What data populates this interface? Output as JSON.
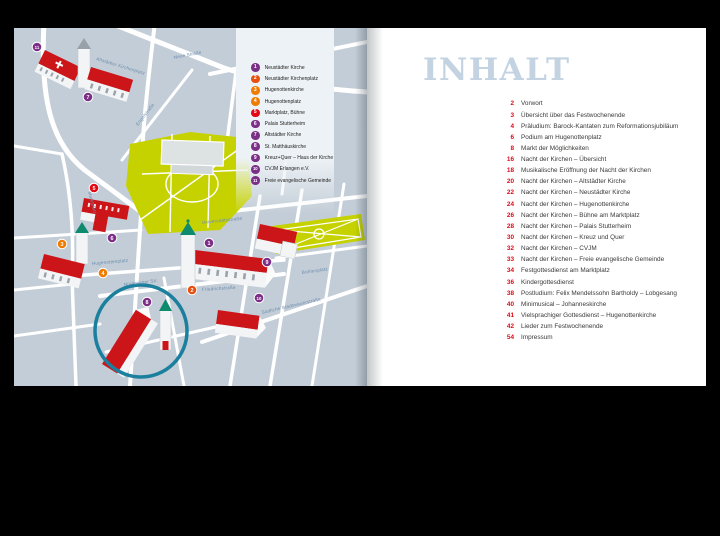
{
  "left_page": {
    "legend": {
      "items": [
        {
          "num": 1,
          "label": "Neustädter Kirche",
          "color": "#7c2f87"
        },
        {
          "num": 2,
          "label": "Neustädter Kirchenplatz",
          "color": "#e8500f"
        },
        {
          "num": 3,
          "label": "Hugenottenkirche",
          "color": "#ef7c00"
        },
        {
          "num": 4,
          "label": "Hugenottenplatz",
          "color": "#ef7c00"
        },
        {
          "num": 5,
          "label": "Marktplatz, Bühne",
          "color": "#e30613"
        },
        {
          "num": 6,
          "label": "Palais Stutterheim",
          "color": "#7c2f87"
        },
        {
          "num": 7,
          "label": "Altstädter Kirche",
          "color": "#7c2f87"
        },
        {
          "num": 8,
          "label": "St. Matthäuskirche",
          "color": "#7c2f87"
        },
        {
          "num": 9,
          "label": "Kreuz+Quer – Haus der Kirche",
          "color": "#7c2f87"
        },
        {
          "num": 10,
          "label": "CVJM Erlangen e.V.",
          "color": "#7c2f87"
        },
        {
          "num": 11,
          "label": "Freie evangelische Gemeinde",
          "color": "#7c2f87"
        }
      ]
    },
    "map": {
      "colors": {
        "background": "#c3cdd7",
        "street": "#ffffff",
        "park": "#c5d200",
        "roof": "#cc1519",
        "wall": "#f3f4f5",
        "tower_cap": "#0e8a6d",
        "highlight": "#1b7f9e",
        "label": "#6b8cad"
      },
      "street_labels": [
        {
          "text": "Altstädter Kirchenplatz",
          "x": 82,
          "y": 32,
          "rotate": 17
        },
        {
          "text": "Neue Straße",
          "x": 160,
          "y": 31,
          "rotate": -11
        },
        {
          "text": "Engelstraße",
          "x": 124,
          "y": 98,
          "rotate": -52
        },
        {
          "text": "Marktplatz",
          "x": 74,
          "y": 164,
          "rotate": 75
        },
        {
          "text": "Universitätsstraße",
          "x": 188,
          "y": 196,
          "rotate": -6
        },
        {
          "text": "Hugenottenplatz",
          "x": 78,
          "y": 237,
          "rotate": -5
        },
        {
          "text": "Nürnberger Str.",
          "x": 110,
          "y": 258,
          "rotate": -7
        },
        {
          "text": "Friedrichstraße",
          "x": 188,
          "y": 263,
          "rotate": -4
        },
        {
          "text": "Bohlenplatz",
          "x": 288,
          "y": 246,
          "rotate": -8
        },
        {
          "text": "Südliche Stadtmauerstraße",
          "x": 248,
          "y": 286,
          "rotate": -13
        }
      ],
      "markers": [
        {
          "num": 1,
          "x": 195,
          "y": 215,
          "color": "#7c2f87"
        },
        {
          "num": 2,
          "x": 178,
          "y": 262,
          "color": "#e8500f"
        },
        {
          "num": 3,
          "x": 48,
          "y": 216,
          "color": "#ef7c00"
        },
        {
          "num": 4,
          "x": 89,
          "y": 245,
          "color": "#ef7c00"
        },
        {
          "num": 5,
          "x": 80,
          "y": 160,
          "color": "#e30613"
        },
        {
          "num": 6,
          "x": 98,
          "y": 210,
          "color": "#7c2f87"
        },
        {
          "num": 7,
          "x": 74,
          "y": 69,
          "color": "#7c2f87"
        },
        {
          "num": 8,
          "x": 133,
          "y": 274,
          "color": "#7c2f87"
        },
        {
          "num": 9,
          "x": 253,
          "y": 234,
          "color": "#7c2f87"
        },
        {
          "num": 10,
          "x": 245,
          "y": 270,
          "color": "#7c2f87"
        },
        {
          "num": 11,
          "x": 23,
          "y": 19,
          "color": "#7c2f87"
        }
      ],
      "highlight_circle": {
        "x": 127,
        "y": 303,
        "r": 46
      }
    }
  },
  "right_page": {
    "title": "INHALT",
    "title_color": "#c3d3e1",
    "toc": {
      "number_color": "#e30613",
      "entries": [
        {
          "page": 2,
          "label": "Vorwort"
        },
        {
          "page": 3,
          "label": "Übersicht über das Festwochenende"
        },
        {
          "page": 4,
          "label": "Präludium: Barock-Kantaten zum Reformationsjubiläum"
        },
        {
          "page": 6,
          "label": "Podium am Hugenottenplatz"
        },
        {
          "page": 8,
          "label": "Markt der Möglichkeiten"
        },
        {
          "page": 16,
          "label": "Nacht der Kirchen – Übersicht"
        },
        {
          "page": 18,
          "label": "Musikalische Eröffnung der Nacht der Kirchen"
        },
        {
          "page": 20,
          "label": "Nacht der Kirchen – Altstädter Kirche"
        },
        {
          "page": 22,
          "label": "Nacht der Kirchen – Neustädter Kirche"
        },
        {
          "page": 24,
          "label": "Nacht der Kirchen – Hugenottenkirche"
        },
        {
          "page": 26,
          "label": "Nacht der Kirchen – Bühne am Marktplatz"
        },
        {
          "page": 28,
          "label": "Nacht der Kirchen – Palais Stutterheim"
        },
        {
          "page": 30,
          "label": "Nacht der Kirchen – Kreuz und Quer"
        },
        {
          "page": 32,
          "label": "Nacht der Kirchen – CVJM"
        },
        {
          "page": 33,
          "label": "Nacht der Kirchen – Freie evangelische Gemeinde"
        },
        {
          "page": 34,
          "label": "Festgottesdienst am Marktplatz"
        },
        {
          "page": 36,
          "label": "Kindergottesdienst"
        },
        {
          "page": 38,
          "label": "Postludium: Felix Mendelssohn Bartholdy – Lobgesang"
        },
        {
          "page": 40,
          "label": "Minimusical – Johanneskirche"
        },
        {
          "page": 41,
          "label": "Vielsprachiger Gottesdienst – Hugenottenkirche"
        },
        {
          "page": 42,
          "label": "Lieder zum Festwochenende"
        },
        {
          "page": 54,
          "label": "Impressum"
        }
      ]
    }
  }
}
